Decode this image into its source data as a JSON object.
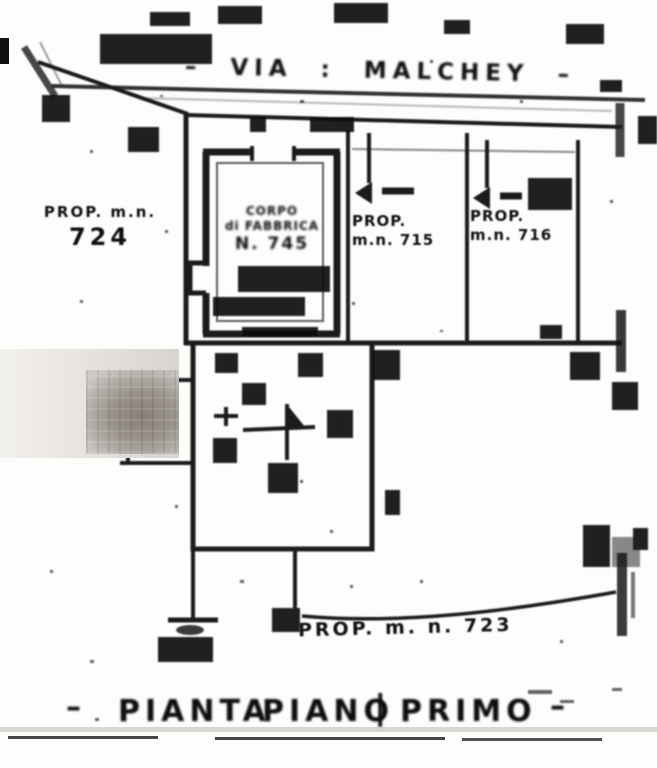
{
  "street": {
    "label": "– VIA : MALCHEY –"
  },
  "parcels": {
    "left": {
      "line1": "PROP. m.n.",
      "line2": "724"
    },
    "central": {
      "line1": "CORPO",
      "line2": "di FABBRICA",
      "line3": "N. 745"
    },
    "p715": {
      "line1": "PROP.",
      "line2": "m.n. 715"
    },
    "p716": {
      "line1": "PROP.",
      "line2": "m.n. 716"
    },
    "p723": {
      "label": "PROP. m. n. 723"
    }
  },
  "caption": {
    "dash_left": "–",
    "word1": "PIANTA",
    "word2": "PIANO",
    "separator": "|",
    "word3": "PRIMO",
    "dash_right": "–"
  },
  "colors": {
    "ink": "#141414",
    "paper": "#fdfdfc",
    "redaction_grey": "#9b948d"
  }
}
